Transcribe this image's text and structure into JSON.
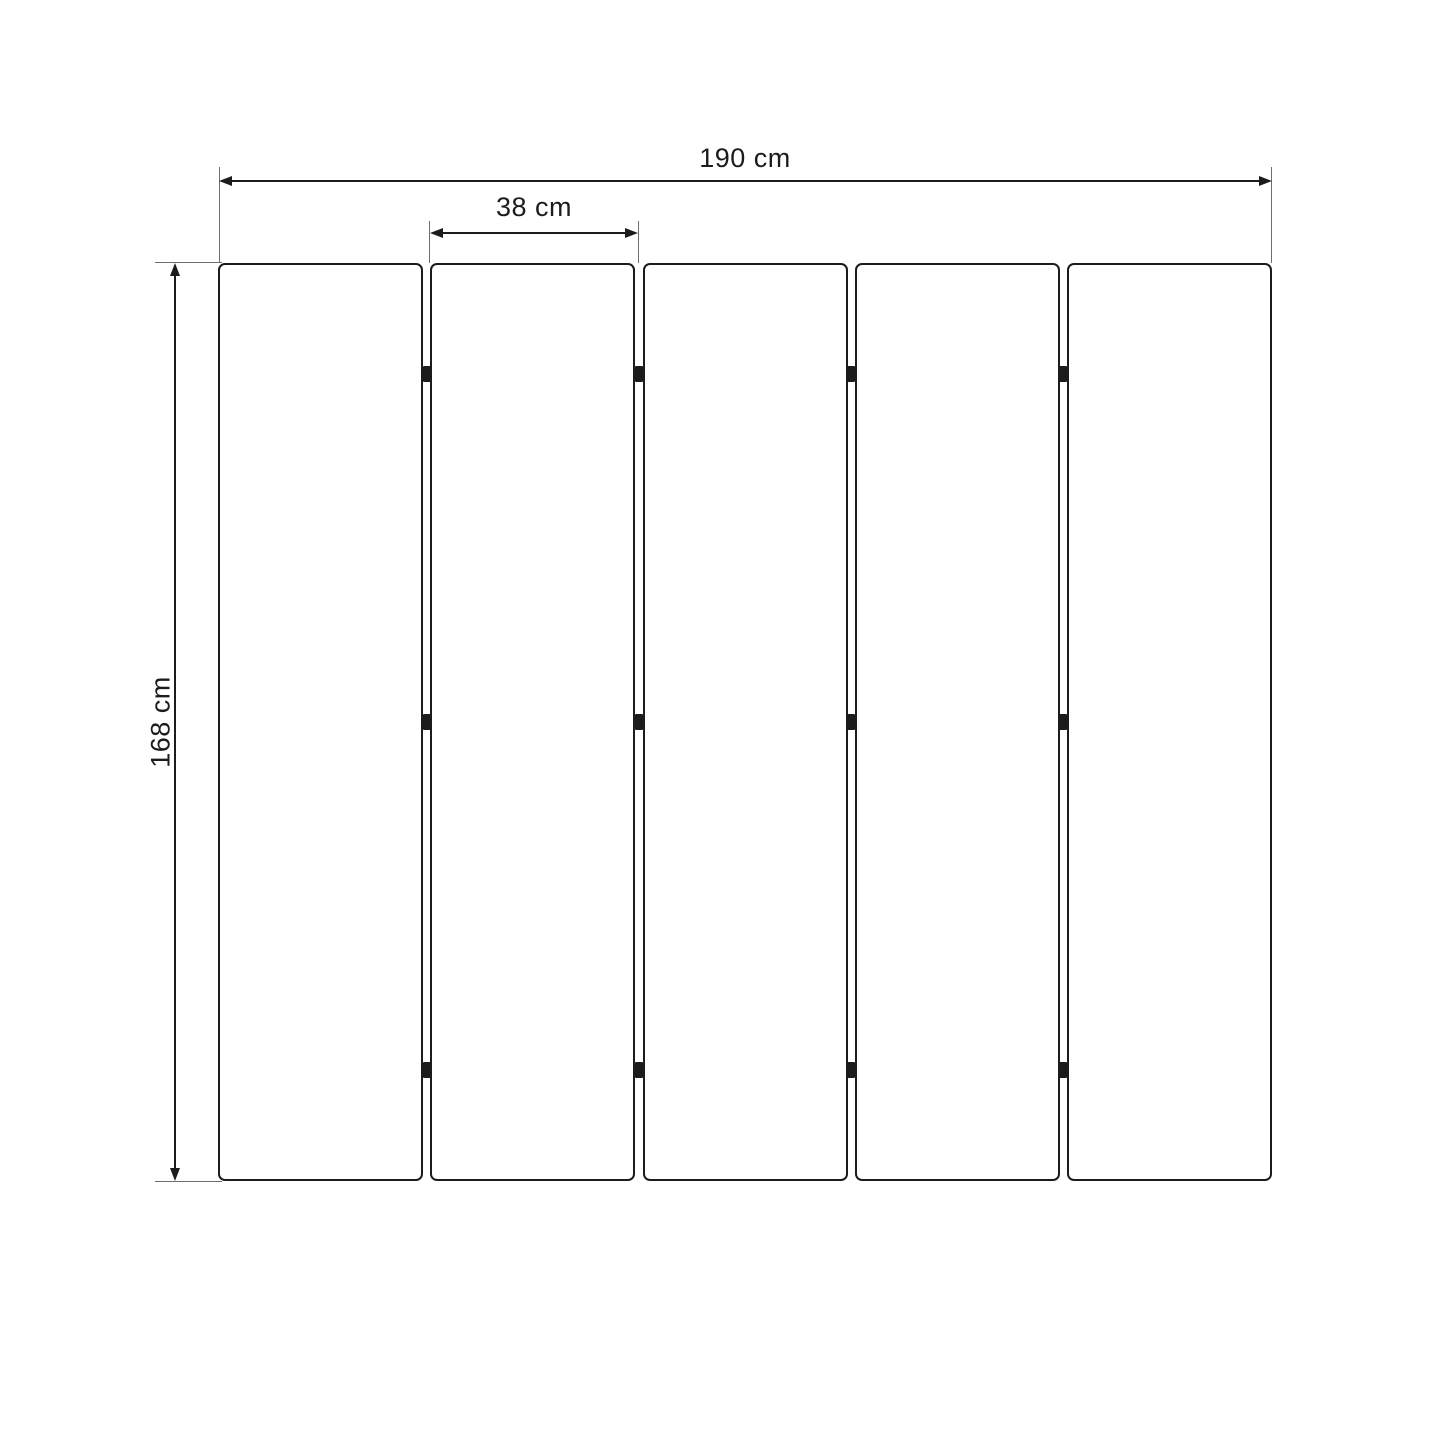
{
  "diagram": {
    "type": "dimension-drawing",
    "subject": "five-panel folding screen, front view",
    "panels": {
      "count": 5,
      "hinge_rows": 3
    },
    "dimensions": {
      "total_width": {
        "value": 190,
        "unit": "cm",
        "label": "190 cm"
      },
      "panel_width": {
        "value": 38,
        "unit": "cm",
        "label": "38 cm"
      },
      "height": {
        "value": 168,
        "unit": "cm",
        "label": "168 cm"
      }
    },
    "colors": {
      "line": "#1c1c1c",
      "extension_line": "#6e6e6e",
      "background": "#ffffff"
    }
  }
}
